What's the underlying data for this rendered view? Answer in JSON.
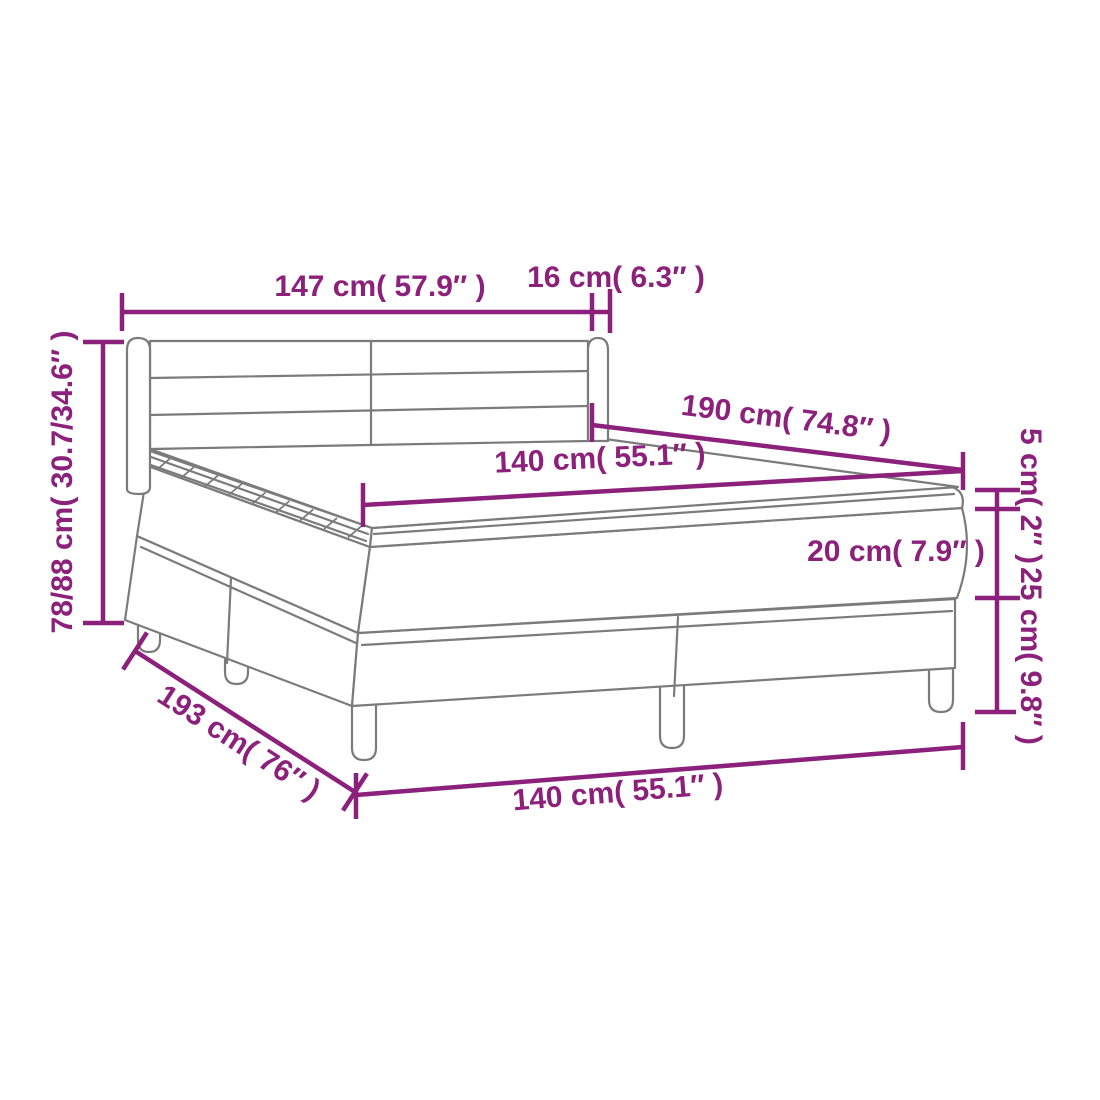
{
  "diagram": {
    "type": "product-dimension-diagram",
    "subject": "box spring bed with headboard, mattress and topper",
    "colors": {
      "dimension_accent": "#8C217C",
      "drawing_outline": "#7B7B7B",
      "background": "#FFFFFF"
    },
    "labels": {
      "headboard_width": "147 cm( 57.9″ )",
      "headboard_side_depth": "16 cm( 6.3″ )",
      "total_height_range": "78/88 cm( 30.7/34.6″ )",
      "mattress_length": "190 cm( 74.8″ )",
      "mattress_width": "140 cm( 55.1″ )",
      "topper_thickness": "5 cm( 2″ )",
      "mattress_thickness": "20 cm( 7.9″ )",
      "base_height": "25 cm( 9.8″ )",
      "base_length": "193 cm( 76″ )",
      "base_width": "140 cm( 55.1″ )"
    }
  }
}
